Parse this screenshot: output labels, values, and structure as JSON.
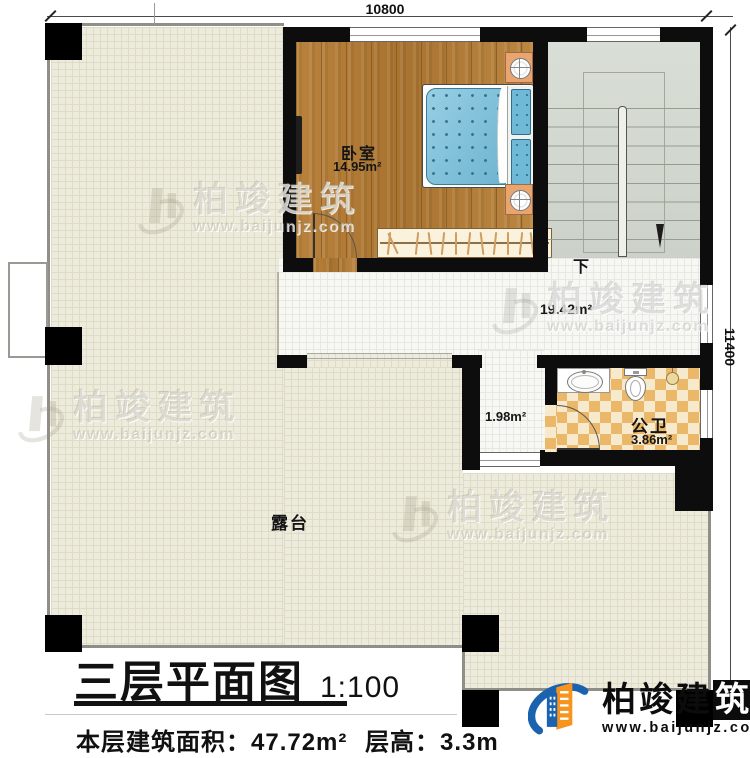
{
  "plan": {
    "title": "三层平面图",
    "scale": "1:100",
    "info": {
      "area_text": "本层建筑面积：47.72m²",
      "floor_height_text": "层高：3.3m"
    },
    "dimensions": {
      "top": "10800",
      "right": "11400"
    },
    "rooms": {
      "bedroom": {
        "name": "卧室",
        "area": "14.95m²"
      },
      "hall": {
        "area": "19.42m²"
      },
      "stairs": {
        "down_label": "下"
      },
      "corridor": {
        "area": "1.98m²"
      },
      "bathroom": {
        "name": "公卫",
        "area": "3.86m²"
      },
      "terrace": {
        "name": "露台"
      }
    },
    "watermark": {
      "brand": "柏竣建筑",
      "url": "www.baijunjz.com"
    },
    "logo": {
      "brand_prefix": "柏竣建",
      "brand_boxed": "筑",
      "url": "www.baijunjz.com"
    },
    "colors": {
      "wall": "#0d0d0d",
      "wood": "#b17c36",
      "terrace": "#edebdc",
      "bathroom_checker": "#eab868",
      "stair": "#d4d9d1",
      "bed_blue": "#74bedb",
      "logo_blue": "#1b63ae",
      "logo_orange": "#f7941d"
    }
  }
}
